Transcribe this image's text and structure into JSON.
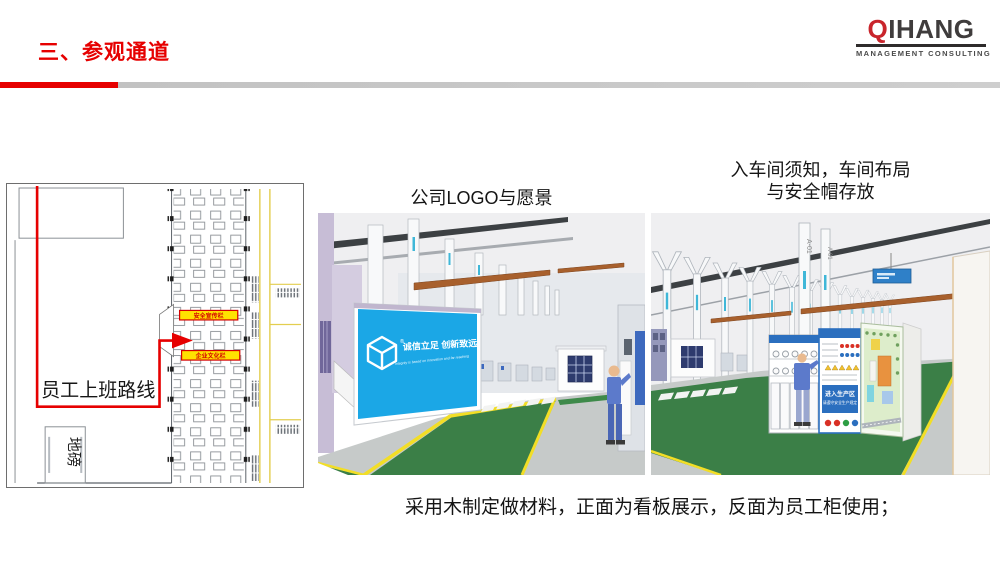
{
  "header": {
    "title": "三、参观通道",
    "logo": {
      "name_accent": "Q",
      "name_rest": "IHANG",
      "subtitle": "MANAGEMENT CONSULTING"
    }
  },
  "floor_plan": {
    "route_label": "员工上班路线",
    "weighbridge_label": "地磅",
    "board_top_label": "安全宣传栏",
    "board_bottom_label": "企业文化栏"
  },
  "captions": {
    "left_image": "公司LOGO与愿景",
    "right_image_line1": "入车间须知，车间布局",
    "right_image_line2": "与安全帽存放"
  },
  "banner": {
    "registered_mark": "®",
    "slogan": "诚信立足 创新致远",
    "tagline": "Integrity is based on innovation and far reaching"
  },
  "right_scene": {
    "column_label": "A-01",
    "board_line1": "进入生产区",
    "board_line2": "请遵守安全生产规定"
  },
  "footer": {
    "note": "采用木制定做材料，正面为看板展示，反面为员工柜使用；"
  },
  "colors": {
    "accent_red": "#E60000",
    "logo_red": "#C9252C",
    "banner_blue": "#1BA7E6",
    "floor_green": "#3B7F47",
    "line_yellow": "#F2DE26",
    "beam_brown": "#A8602D",
    "wall_purple": "#C7BDD6",
    "board_blue": "#2B6FBF"
  }
}
